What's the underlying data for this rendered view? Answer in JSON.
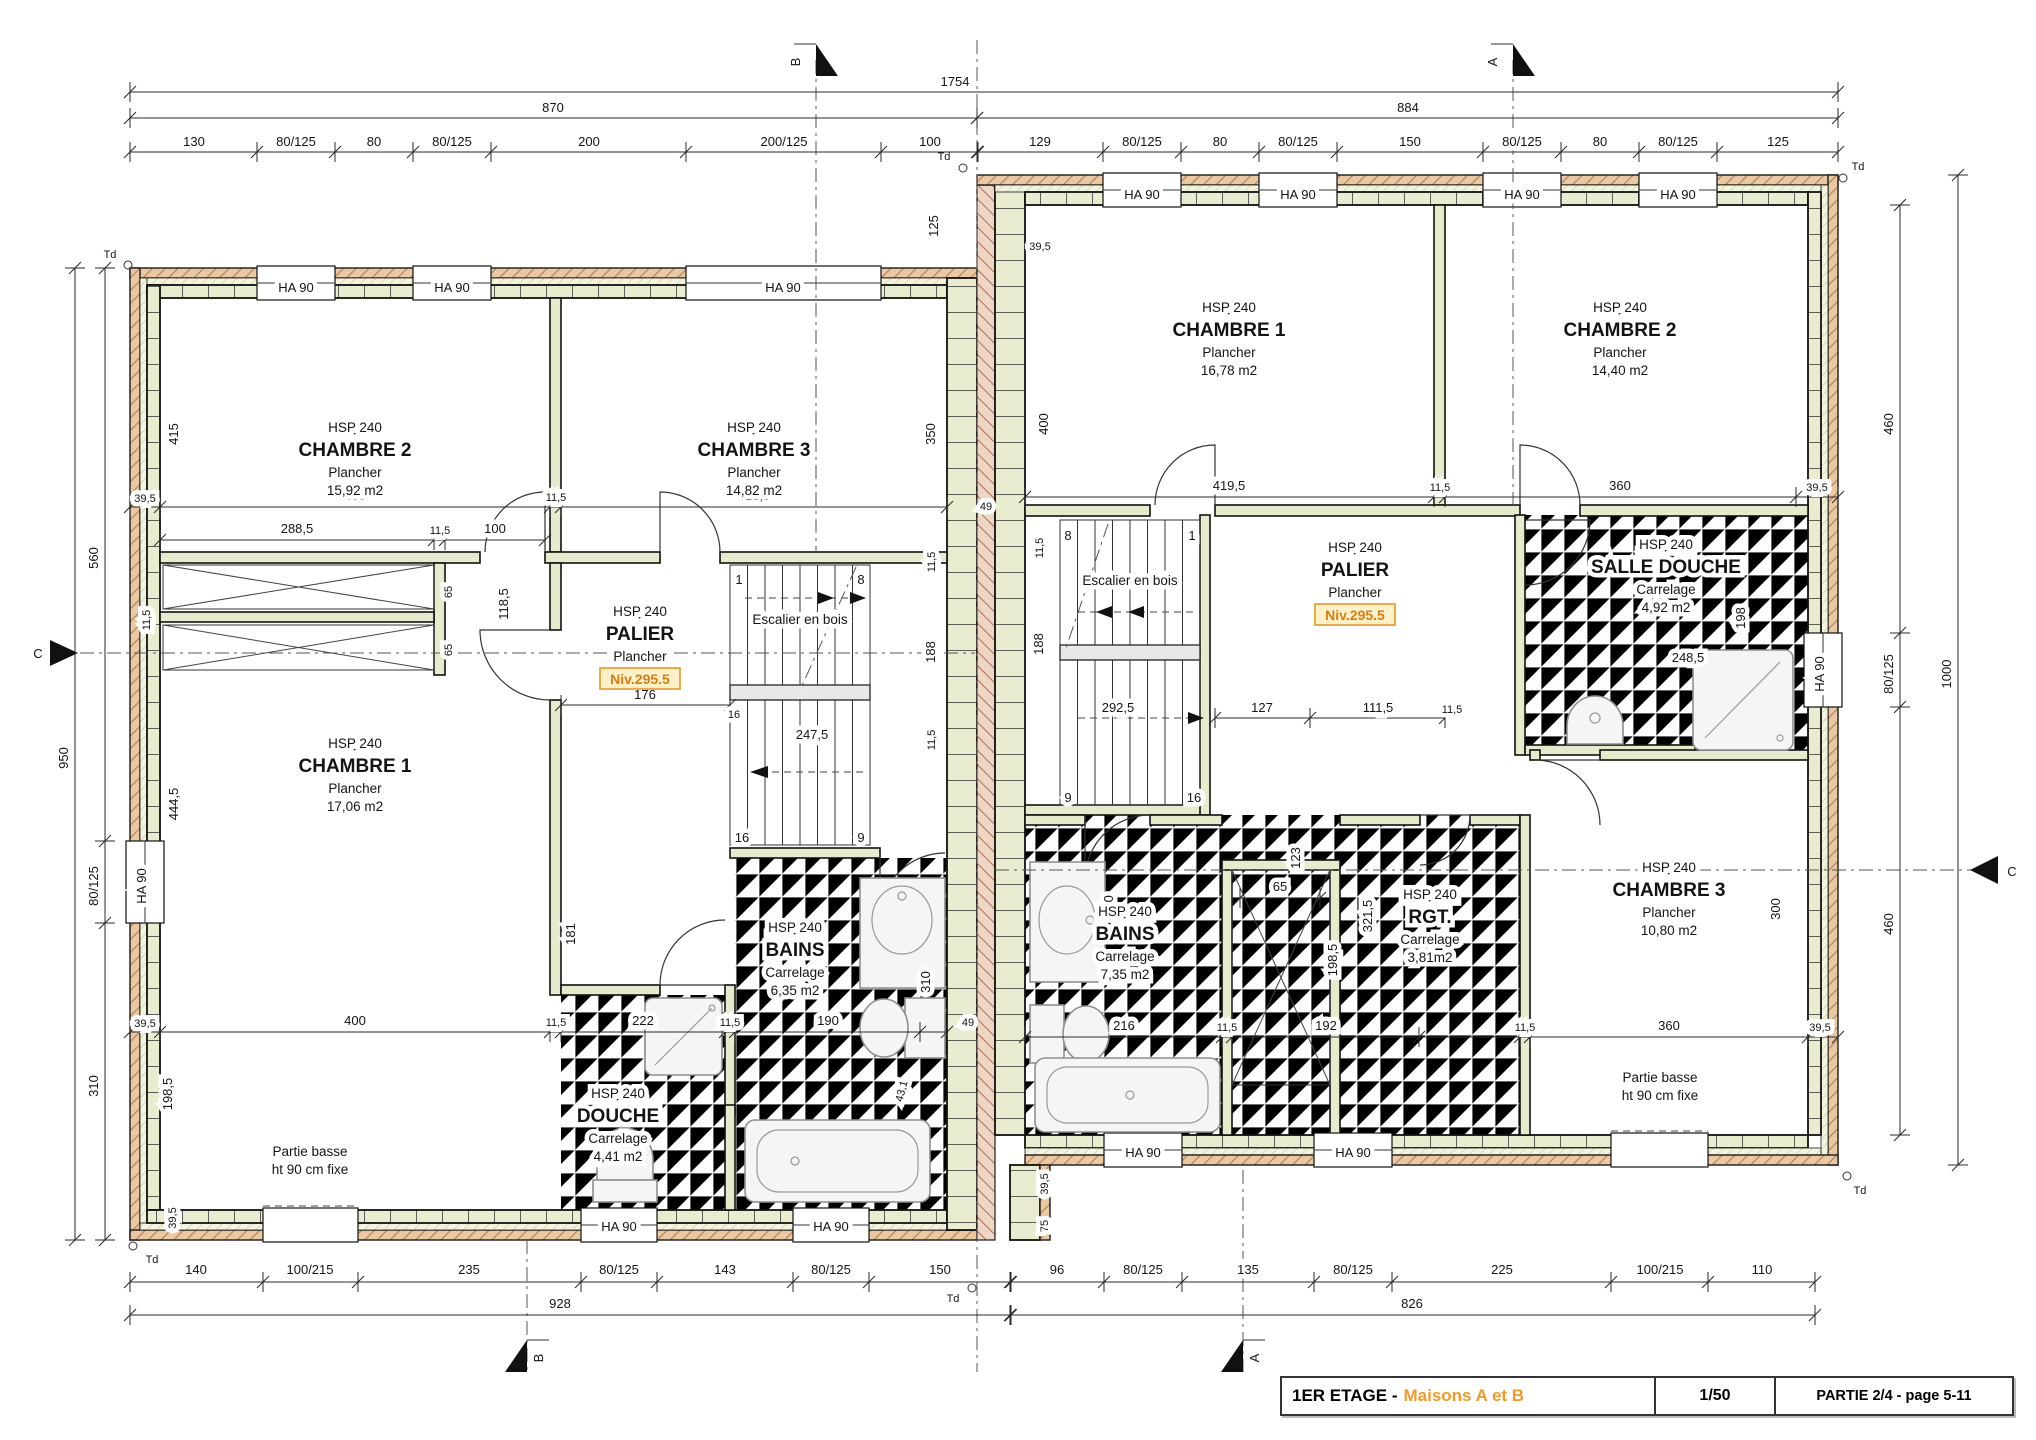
{
  "title_block": {
    "title_black": "1ER ETAGE -",
    "title_orange": "Maisons A et B",
    "scale": "1/50",
    "part": "PARTIE 2/4 - page 5-11"
  },
  "markers": {
    "a": "A",
    "b": "B",
    "c": "C",
    "td": "Td"
  },
  "labels": {
    "window": "HA 90",
    "stairs": "Escalier en bois",
    "niv": "Niv.295.5",
    "pb1": "Partie basse",
    "pb2": "ht 90 cm fixe"
  },
  "rooms": {
    "l_ch2": {
      "hsp": "HSP 240",
      "name": "CHAMBRE 2",
      "sub": "Plancher",
      "area": "15,92 m2"
    },
    "l_ch3": {
      "hsp": "HSP 240",
      "name": "CHAMBRE 3",
      "sub": "Plancher",
      "area": "14,82 m2"
    },
    "l_ch1": {
      "hsp": "HSP 240",
      "name": "CHAMBRE 1",
      "sub": "Plancher",
      "area": "17,06 m2"
    },
    "l_palier": {
      "hsp": "HSP 240",
      "name": "PALIER",
      "sub": "Plancher"
    },
    "l_bains": {
      "hsp": "HSP 240",
      "name": "BAINS",
      "sub": "Carrelage",
      "area": "6,35 m2"
    },
    "l_douche": {
      "hsp": "HSP 240",
      "name": "DOUCHE",
      "sub": "Carrelage",
      "area": "4,41 m2"
    },
    "r_ch1": {
      "hsp": "HSP 240",
      "name": "CHAMBRE 1",
      "sub": "Plancher",
      "area": "16,78 m2"
    },
    "r_ch2": {
      "hsp": "HSP 240",
      "name": "CHAMBRE 2",
      "sub": "Plancher",
      "area": "14,40 m2"
    },
    "r_ch3": {
      "hsp": "HSP 240",
      "name": "CHAMBRE 3",
      "sub": "Plancher",
      "area": "10,80 m2"
    },
    "r_palier": {
      "hsp": "HSP 240",
      "name": "PALIER",
      "sub": "Plancher"
    },
    "r_sd": {
      "hsp": "HSP 240",
      "name": "SALLE DOUCHE",
      "sub": "Carrelage",
      "area": "4,92 m2"
    },
    "r_bains": {
      "hsp": "HSP 240",
      "name": "BAINS",
      "sub": "Carrelage",
      "area": "7,35 m2"
    },
    "r_rgt": {
      "hsp": "HSP 240",
      "name": "RGT.",
      "sub": "Carrelage",
      "area": "3,81m2"
    }
  },
  "dims": {
    "totals": {
      "t1754": "1754",
      "t870": "870",
      "t884": "884",
      "t928": "928",
      "t826": "826",
      "t950": "950",
      "t1000": "1000"
    },
    "chains": {
      "lh_top": [
        "130",
        "80/125",
        "80",
        "80/125",
        "200",
        "200/125",
        "100"
      ],
      "rh_top": [
        "129",
        "80/125",
        "80",
        "80/125",
        "150",
        "80/125",
        "80",
        "80/125",
        "125"
      ],
      "lh_bot": [
        "140",
        "100/215",
        "235",
        "80/125",
        "143",
        "80/125",
        "150"
      ],
      "rh_bot": [
        "96",
        "80/125",
        "135",
        "80/125",
        "225",
        "100/215",
        "110"
      ],
      "left": [
        "560",
        "80/125",
        "310"
      ],
      "right": [
        "460",
        "80/125",
        "460"
      ]
    },
    "inner": {
      "w395": "39,5",
      "w115": "11,5",
      "d400": "400",
      "d4235": "423,5",
      "d49": "49",
      "d4195": "419,5",
      "d360": "360",
      "d2885": "288,5",
      "d100": "100",
      "d65": "65",
      "d1185": "118,5",
      "d176": "176",
      "d16": "16",
      "d2475": "247,5",
      "d188": "188",
      "d350": "350",
      "d181": "181",
      "d415": "415",
      "d4445": "444,5",
      "d1985": "198,5",
      "d222": "222",
      "d190": "190",
      "d310": "310",
      "d431": "43,1",
      "d2925": "292,5",
      "d127": "127",
      "d1115": "111,5",
      "d123": "123",
      "d3215": "321,5",
      "d216": "216",
      "d192": "192",
      "d75": "75",
      "d300": "300",
      "d198": "198",
      "d2485": "248,5",
      "d125": "125",
      "s1": "1",
      "s8": "8",
      "s9": "9",
      "s16": "16"
    }
  }
}
